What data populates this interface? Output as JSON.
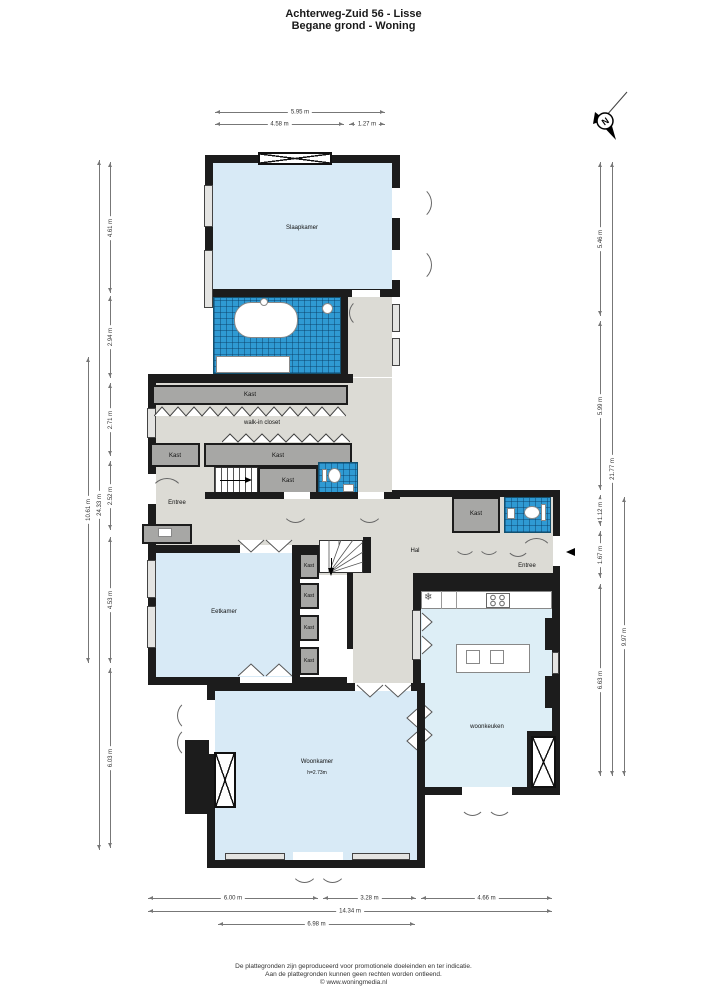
{
  "title": {
    "line1": "Achterweg-Zuid 56 - Lisse",
    "line2": "Begane grond - Woning"
  },
  "compass": {
    "north_label": "N"
  },
  "rooms": {
    "slaapkamer": "Slaapkamer",
    "walk_in_closet": "walk-in closet",
    "kast": "Kast",
    "entree": "Entree",
    "hal": "Hal",
    "eetkamer": "Eetkamer",
    "woonkeuken": "woonkeuken",
    "woonkamer": "Woonkamer",
    "woonkamer_ceiling_height": "h=2.73m"
  },
  "dimensions": {
    "top": [
      "5.95 m",
      "4.58 m",
      "1.27 m"
    ],
    "left_total": "24.33 m",
    "left_outer": "10.61 m",
    "left_segments": [
      "4.61 m",
      "2.94 m",
      "2.71 m",
      "2.52 m",
      "4.53 m",
      "6.03 m"
    ],
    "right_total": "21.77 m",
    "right_lower": "9.97 m",
    "right_segments": [
      "5.46 m",
      "5.99 m",
      "1.12 m",
      "1.67 m",
      "6.63 m"
    ],
    "bottom_total": "14.34 m",
    "bottom_partial": "6.98 m",
    "bottom_segments": [
      "6.00 m",
      "3.28 m",
      "4.66 m"
    ]
  },
  "footer": {
    "line1": "De plattegronden zijn geproduceerd voor promotionele doeleinden en ter indicatie.",
    "line2": "Aan de plattegronden kunnen geen rechten worden ontleend.",
    "line3": "© www.woningmedia.nl"
  },
  "colors": {
    "wall": "#1c1c1c",
    "room_fill": "#d8eaf6",
    "tile_fill": "#2f9ad3",
    "floor_fill": "#dcdbd5",
    "closet_fill": "#a7a7a5"
  }
}
